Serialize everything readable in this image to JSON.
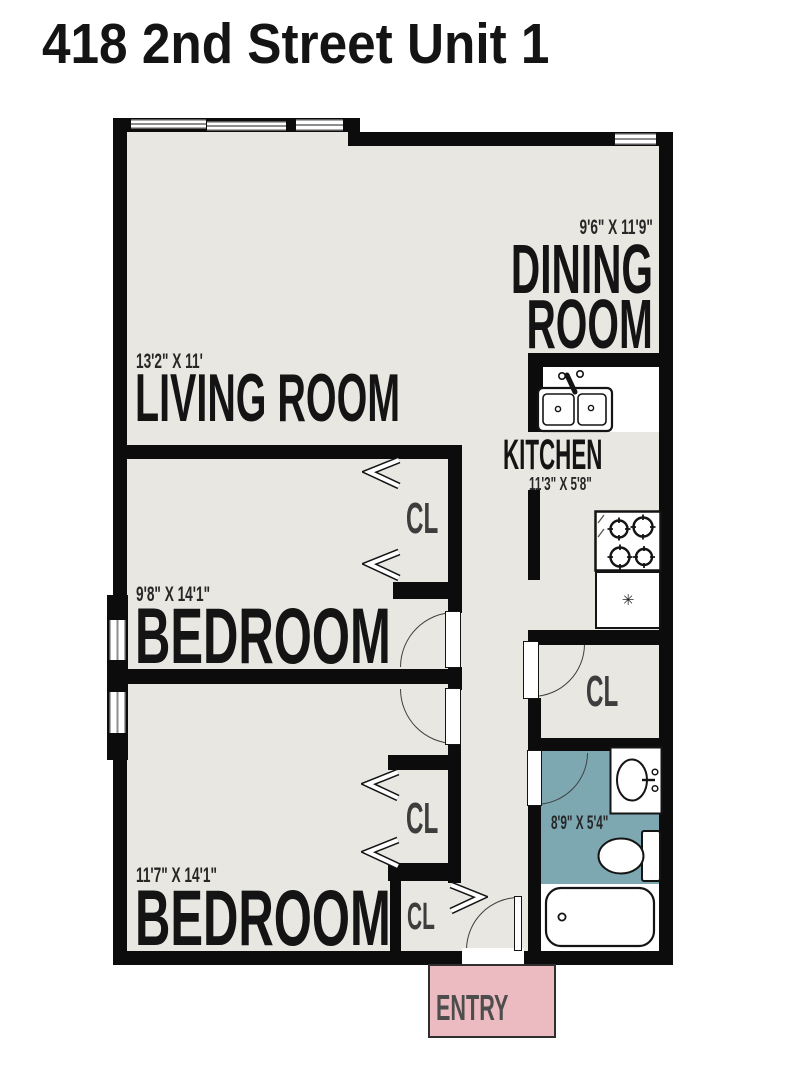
{
  "title": "418 2nd Street Unit 1",
  "rooms": {
    "dining": {
      "line1": "DINING",
      "line2": "ROOM",
      "dims": "9'6\" X 11'9\""
    },
    "living": {
      "name": "LIVING ROOM",
      "dims": "13'2\" X 11'"
    },
    "kitchen": {
      "name": "KITCHEN",
      "dims": "11'3\" X 5'8\""
    },
    "bedroom1": {
      "name": "BEDROOM",
      "dims": "9'8\" X 14'1\""
    },
    "bedroom2": {
      "name": "BEDROOM",
      "dims": "11'7\" X 14'1\""
    },
    "bathroom": {
      "dims": "8'9\" X 5'4\""
    },
    "entry": {
      "name": "ENTRY"
    },
    "closet": {
      "label": "CL"
    }
  },
  "icons": {
    "refrigerator_glyph": "✳"
  },
  "colors": {
    "floor": "#e9e7e1",
    "wall": "#0c0c0c",
    "bathroom_floor": "#7da8b2",
    "entry_floor": "#ecbac1",
    "label_text": "#141414"
  }
}
